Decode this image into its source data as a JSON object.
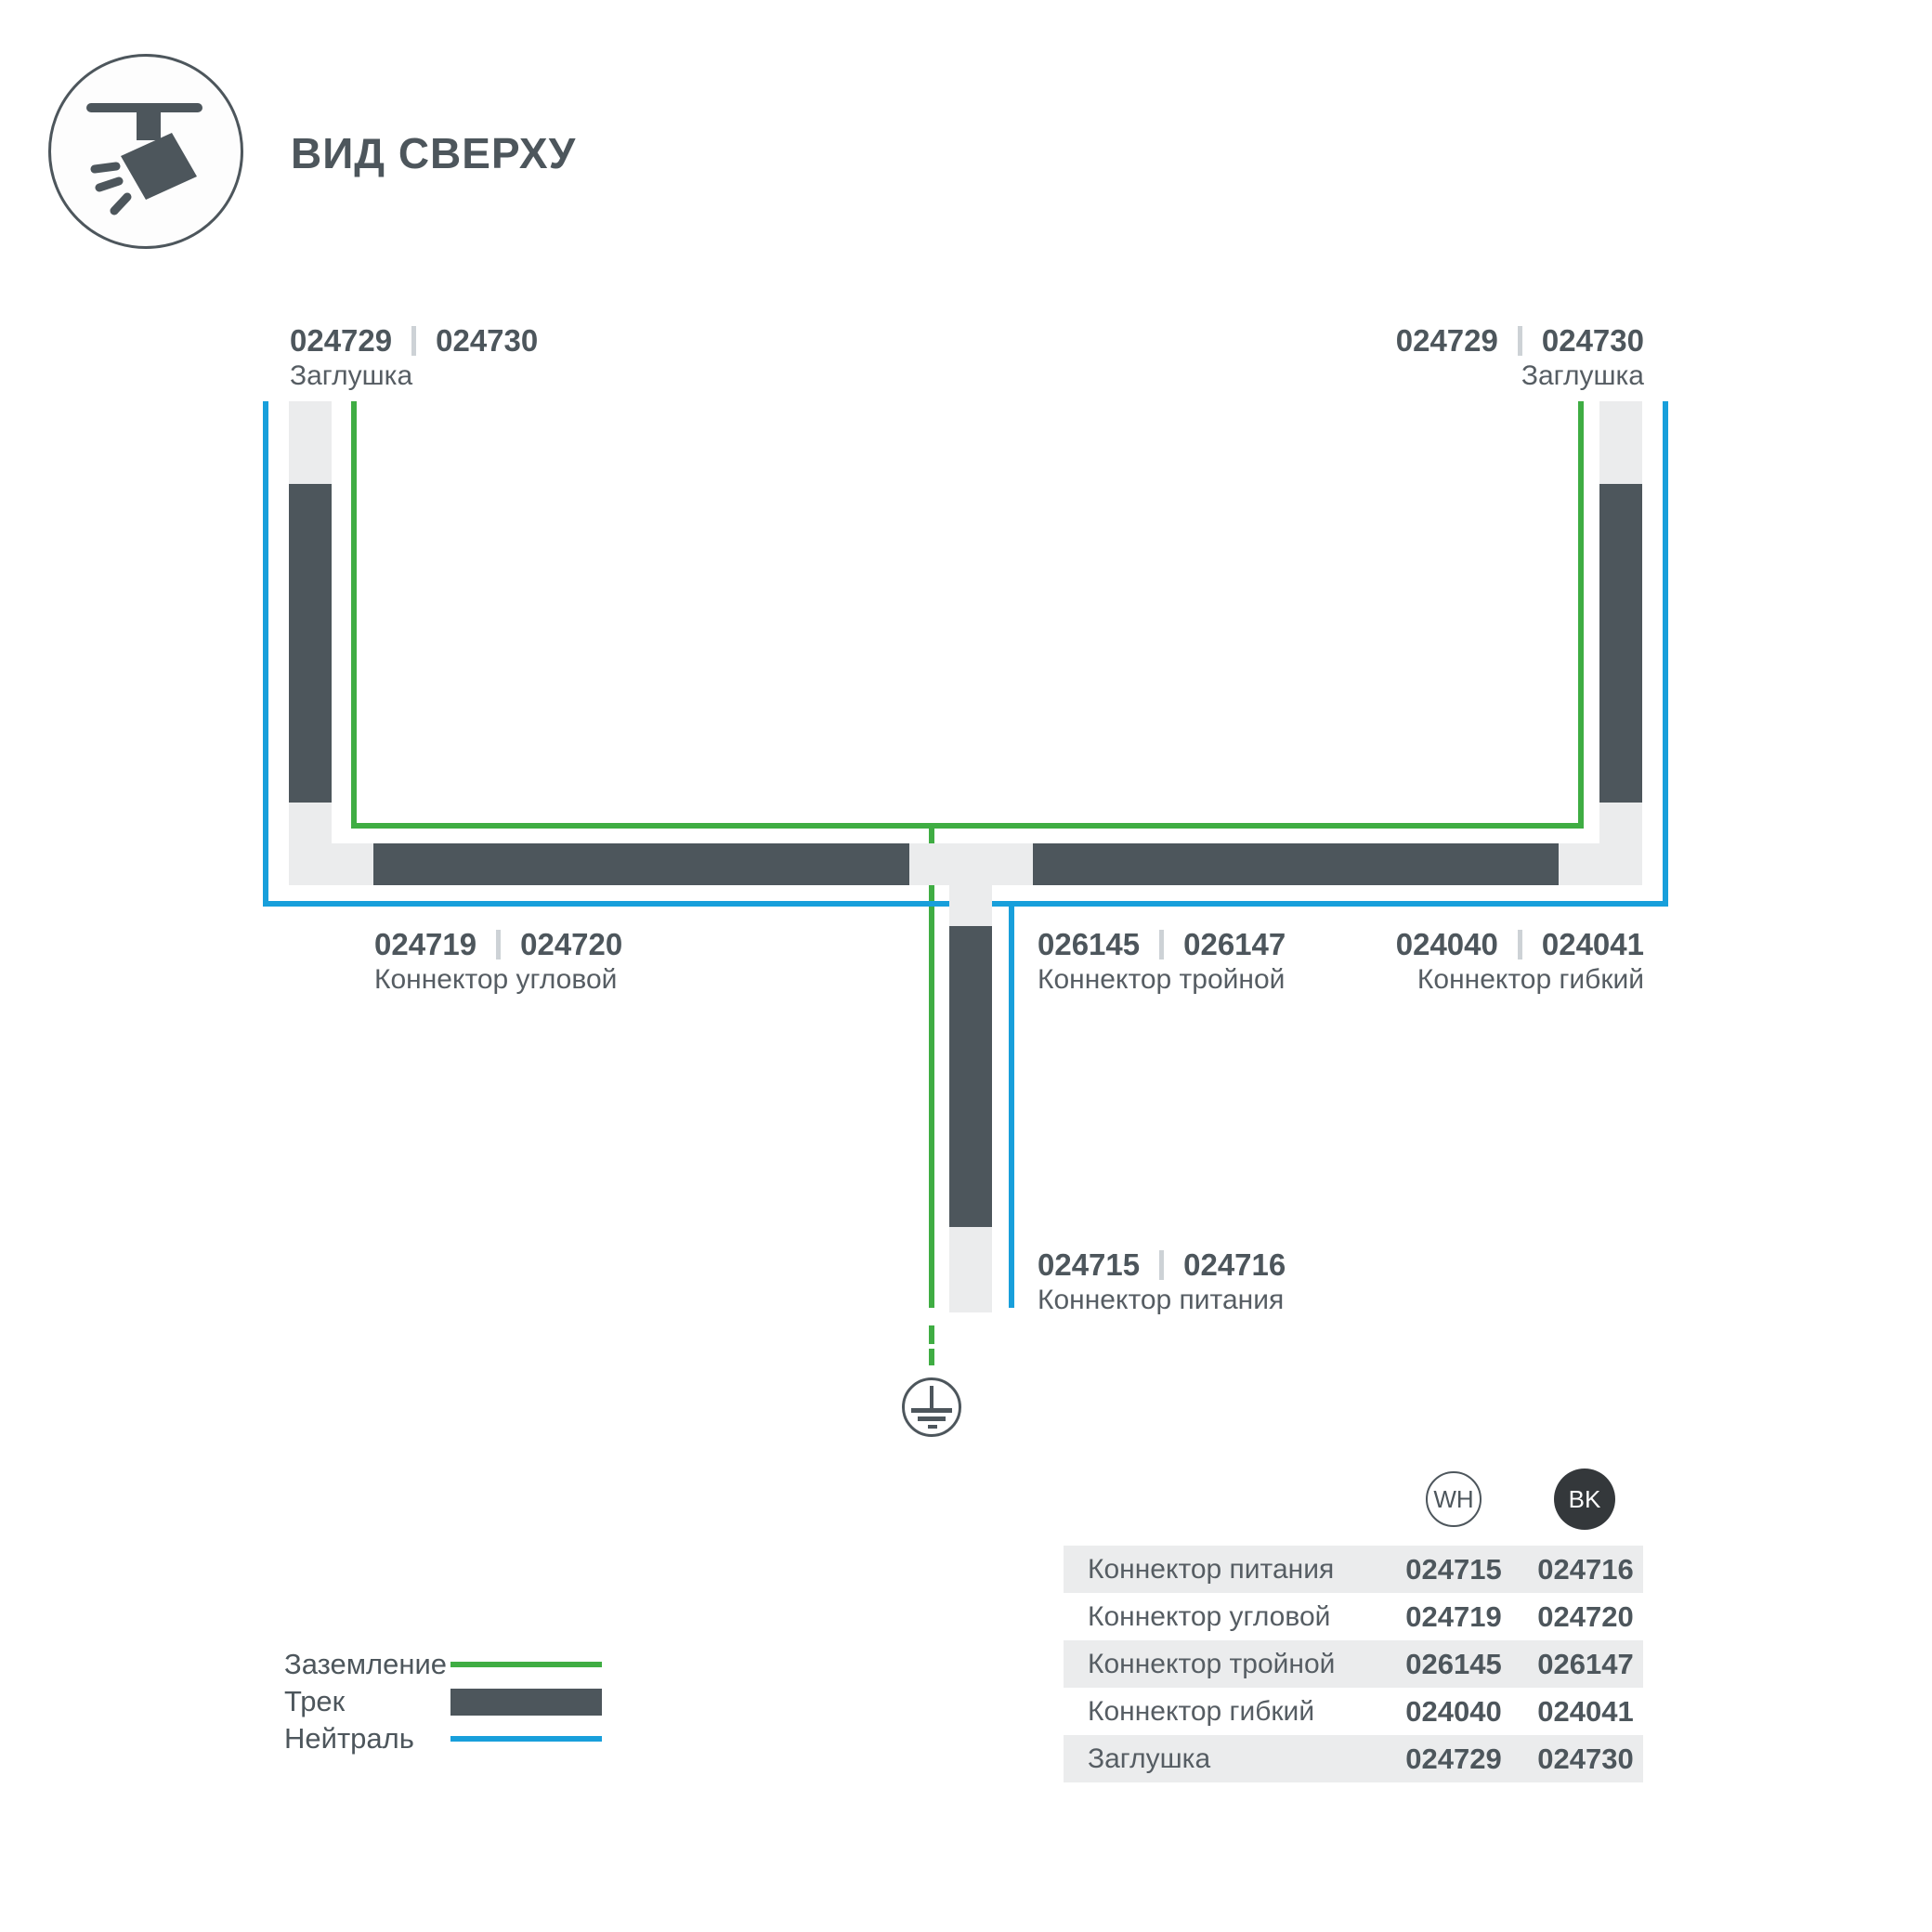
{
  "header": {
    "title": "ВИД СВЕРХУ"
  },
  "diagram": {
    "labels": {
      "cap_left": {
        "wh": "024729",
        "bk": "024730",
        "name": "Заглушка"
      },
      "cap_right": {
        "wh": "024729",
        "bk": "024730",
        "name": "Заглушка"
      },
      "corner": {
        "wh": "024719",
        "bk": "024720",
        "name": "Коннектор угловой"
      },
      "triple": {
        "wh": "026145",
        "bk": "026147",
        "name": "Коннектор тройной"
      },
      "flexible": {
        "wh": "024040",
        "bk": "024041",
        "name": "Коннектор гибкий"
      },
      "power": {
        "wh": "024715",
        "bk": "024716",
        "name": "Коннектор питания"
      }
    }
  },
  "legend": {
    "items": [
      {
        "label": "Заземление",
        "type": "ground"
      },
      {
        "label": "Трек",
        "type": "track"
      },
      {
        "label": "Нейтраль",
        "type": "neutral"
      }
    ]
  },
  "table": {
    "columns": {
      "wh": "WH",
      "bk": "BK"
    },
    "rows": [
      {
        "label": "Коннектор питания",
        "wh": "024715",
        "bk": "024716"
      },
      {
        "label": "Коннектор угловой",
        "wh": "024719",
        "bk": "024720"
      },
      {
        "label": "Коннектор тройной",
        "wh": "026145",
        "bk": "026147"
      },
      {
        "label": "Коннектор гибкий",
        "wh": "024040",
        "bk": "024041"
      },
      {
        "label": "Заглушка",
        "wh": "024729",
        "bk": "024730"
      }
    ]
  },
  "colors": {
    "ground": "#3fad43",
    "neutral": "#189fdb",
    "track": "#4d565c",
    "connector": "#ebeced"
  }
}
